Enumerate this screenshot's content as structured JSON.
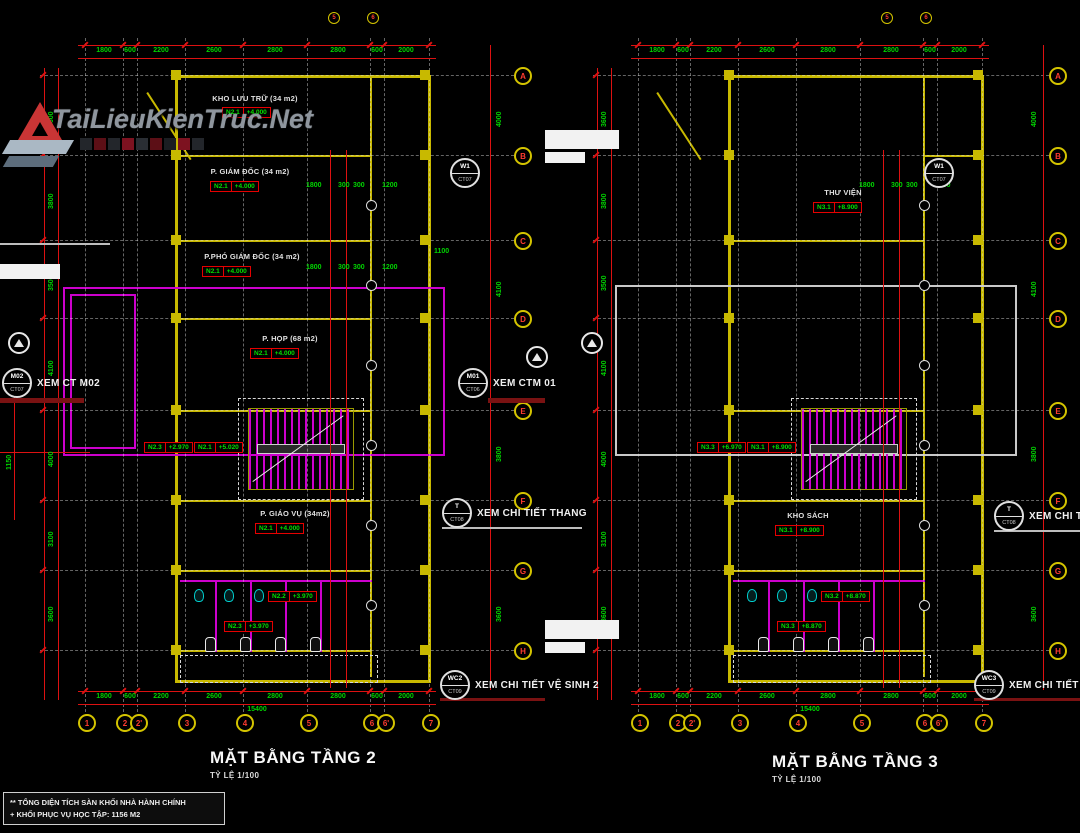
{
  "watermark": {
    "brand": "TaiLieuKienTruc.Net"
  },
  "note_box": {
    "line1": "** TỔNG DIỆN TÍCH SÀN KHỐI NHÀ HÀNH CHÍNH",
    "line2": "+ KHỐI PHỤC VỤ HỌC TẬP: 1156 M2"
  },
  "axes": {
    "rows": [
      "A",
      "B",
      "C",
      "D",
      "E",
      "F",
      "G",
      "H"
    ],
    "cols": [
      "1",
      "2",
      "2'",
      "3",
      "4",
      "5",
      "6",
      "6'",
      "7"
    ],
    "top_cols": [
      "5",
      "6"
    ]
  },
  "dims": {
    "bottom_chain": [
      "1800",
      "600",
      "2200",
      "2600",
      "2800",
      "2800",
      "600",
      "2000"
    ],
    "bottom_total": "15400",
    "left_chain": [
      "3600",
      "3800",
      "3500",
      "4100",
      "4000",
      "3100",
      "3600"
    ],
    "right_chain": [
      "4000",
      "4100",
      "3800",
      "3600"
    ],
    "inner": [
      "1800",
      "300",
      "300",
      "1200",
      "1100",
      "1150"
    ]
  },
  "plans": [
    {
      "title": "MẶT BẰNG TẦNG 2",
      "scale": "TỶ LỆ 1/100",
      "rooms": [
        {
          "name": "KHO LƯU TRỮ (34 m2)",
          "tag": "N2.1",
          "elev": "+4.000"
        },
        {
          "name": "P. GIÁM ĐỐC (34 m2)",
          "tag": "N2.1",
          "elev": "+4.000"
        },
        {
          "name": "P.PHÓ GIÁM ĐỐC (34 m2)",
          "tag": "N2.1",
          "elev": "+4.000"
        },
        {
          "name": "P. HỌP (68 m2)",
          "tag": "N2.1",
          "elev": "+4.000"
        },
        {
          "name": "P. GIÁO VỤ (34m2)",
          "tag": "N2.1",
          "elev": "+4.000"
        }
      ],
      "stair_tags": [
        {
          "tag": "N2.3",
          "elev": "+2.970"
        },
        {
          "tag": "N2.1",
          "elev": "+5.020"
        }
      ],
      "wc_tags": [
        {
          "tag": "N2.2",
          "elev": "+3.970"
        },
        {
          "tag": "N2.3",
          "elev": "+3.970"
        }
      ]
    },
    {
      "title": "MẶT BẰNG TẦNG 3",
      "scale": "TỶ LỆ 1/100",
      "rooms": [
        {
          "name": "THƯ VIỆN",
          "tag": "N3.1",
          "elev": "+8.900"
        },
        {
          "name": "KHO SÁCH",
          "tag": "N3.1",
          "elev": "+8.900"
        }
      ],
      "stair_tags": [
        {
          "tag": "N3.3",
          "elev": "+6.970"
        },
        {
          "tag": "N3.1",
          "elev": "+8.900"
        }
      ],
      "wc_tags": [
        {
          "tag": "N3.2",
          "elev": "+8.870"
        },
        {
          "tag": "N3.3",
          "elev": "+8.870"
        }
      ]
    }
  ],
  "callouts": {
    "m02": {
      "top": "M02",
      "bottom": "CT07",
      "label": "XEM CT M02"
    },
    "m01": {
      "top": "M01",
      "bottom": "CT06",
      "label": "XEM CTM 01"
    },
    "w1": {
      "top": "W1",
      "bottom": "CT07",
      "label": ""
    },
    "stair": {
      "top": "T",
      "bottom": "CT08",
      "label": "XEM CHI TIẾT THANG"
    },
    "wc2": {
      "top": "WC2",
      "bottom": "CT09",
      "label": "XEM CHI TIẾT VỆ SINH 2"
    },
    "wc3": {
      "top": "WC3",
      "bottom": "CT09",
      "label": "XEM CHI TIẾT VỆ SINH 3"
    }
  },
  "colors": {
    "wall": "#c8b900",
    "dimension": "#dd1111",
    "dimension_text": "#00d400",
    "magenta": "#cc00cc",
    "elevation_text": "#00e000",
    "bubble_ring": "#d4c400",
    "bubble_text": "#ff3b30"
  }
}
